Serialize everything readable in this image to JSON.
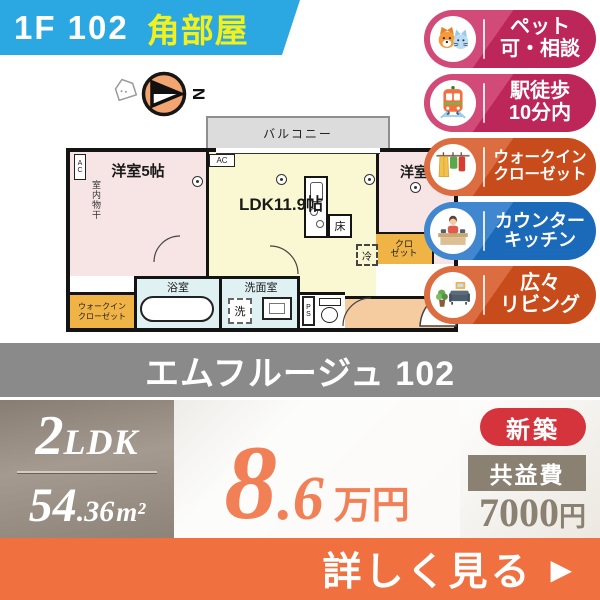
{
  "header": {
    "unit": "1F 102",
    "corner": "角部屋"
  },
  "compass": {
    "north": "N"
  },
  "floorplan": {
    "balcony": "バルコニー",
    "room_left": "洋室5帖",
    "room_left_ac": "AC",
    "room_left_drying": "室内物干",
    "ldk": "LDK11.9帖",
    "ldk_ac": "AC",
    "floor_storage": "床",
    "fridge": "冷",
    "room_right": "洋室",
    "closet_line1": "クロ",
    "closet_line2": "ゼット",
    "bath": "浴室",
    "wash_room": "洗面室",
    "laundry": "洗",
    "ps": "PS",
    "walkin_line1": "ウォークイン",
    "walkin_line2": "クローゼット"
  },
  "features": [
    {
      "line1": "ペット",
      "line2": "可・相談",
      "color": "#c9285e",
      "icon": "pets-icon"
    },
    {
      "line1": "駅徒歩",
      "line2": "10分内",
      "color": "#c9285e",
      "icon": "train-icon"
    },
    {
      "line1": "ウォークイン",
      "line2": "クローゼット",
      "color": "#d4511d",
      "icon": "walkin-closet-icon"
    },
    {
      "line1": "カウンター",
      "line2": "キッチン",
      "color": "#1d70c6",
      "icon": "counter-kitchen-icon"
    },
    {
      "line1": "広々",
      "line2": "リビング",
      "color": "#d4511d",
      "icon": "living-room-icon"
    }
  ],
  "building": {
    "name": "エムフルージュ 102"
  },
  "details": {
    "layout": {
      "num": "2",
      "type": "LDK"
    },
    "area": {
      "int": "54",
      "dec": ".36",
      "unit": "m²"
    },
    "rent": {
      "int": "8",
      "dec": ".6",
      "unit": "万円"
    },
    "new_badge": "新築",
    "fee_label": "共益費",
    "fee": {
      "num": "7000",
      "unit": "円"
    }
  },
  "cta": {
    "label": "詳しく見る",
    "arrow": "▶"
  },
  "colors": {
    "banner_blue": "#2ba7e1",
    "corner_yellow": "#f3f11c",
    "badge_pink": "#c9285e",
    "badge_vermilion": "#d4511d",
    "badge_blue": "#1d70c6",
    "band_gray": "#8a8a8a",
    "layout_taupe": "#968c82",
    "rent_orange": "#f28057",
    "new_red": "#d6343c",
    "fee_brown": "#8a8172",
    "cta_orange": "#f1703f"
  }
}
